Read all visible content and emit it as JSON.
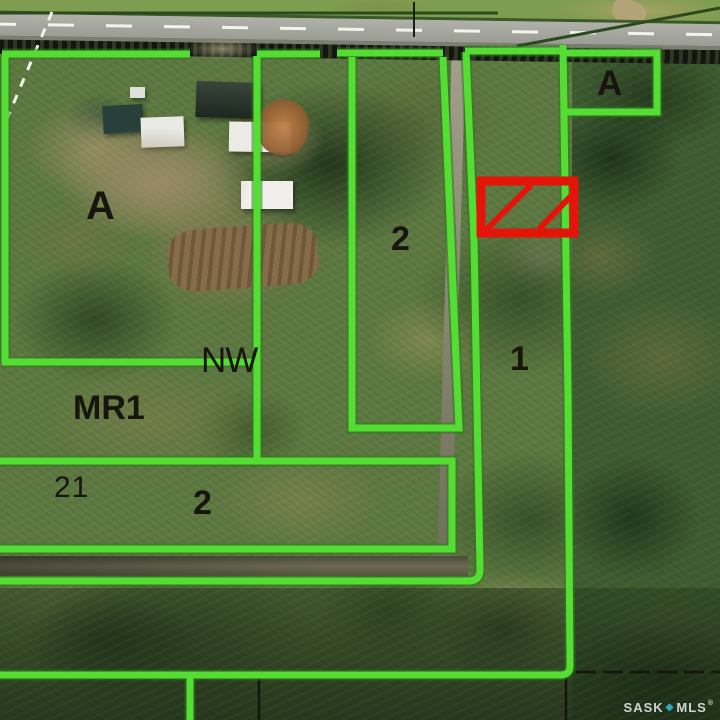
{
  "map": {
    "title": "aerial-parcel-map",
    "labels": [
      {
        "id": "parcel-a-west",
        "text": "A"
      },
      {
        "id": "parcel-a-northeast",
        "text": "A"
      },
      {
        "id": "parcel-2-north",
        "text": "2"
      },
      {
        "id": "parcel-1",
        "text": "1"
      },
      {
        "id": "quarter-section-nw",
        "text": "NW"
      },
      {
        "id": "parcel-mr1",
        "text": "MR1"
      },
      {
        "id": "section-21",
        "text": "21"
      },
      {
        "id": "parcel-2-south",
        "text": "2"
      }
    ],
    "colors": {
      "boundary": "#54de33",
      "highlight": "#e51408",
      "label": "#17150e"
    },
    "highlight": {
      "meaning": "subject-parcel",
      "color": "#e51408"
    },
    "watermark": {
      "brand_left": "SASK",
      "brand_right": "MLS",
      "registered": "®",
      "icon_glyph": "◆",
      "icon_color": "#2fa9c0"
    }
  }
}
